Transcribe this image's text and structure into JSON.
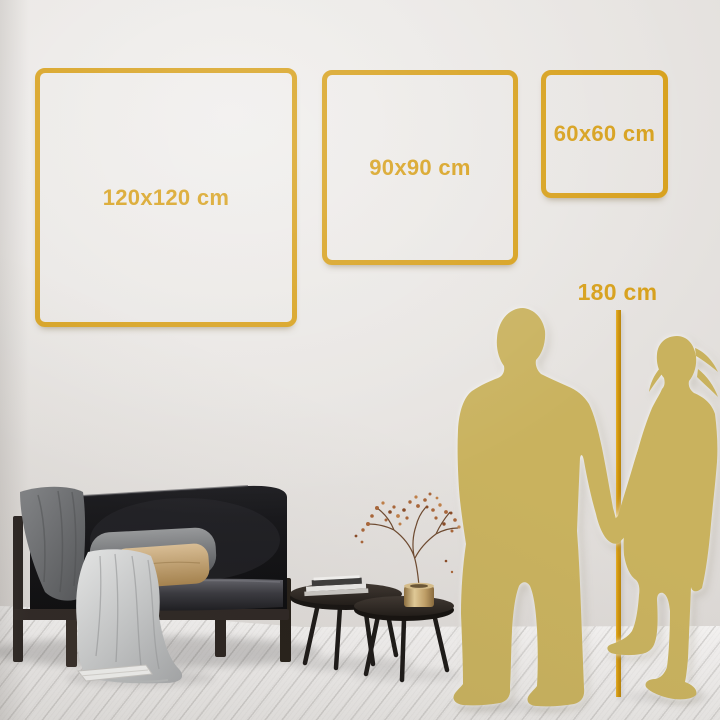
{
  "size_guide": {
    "unit": "cm",
    "frames": [
      {
        "id": "frame-120",
        "label": "120x120 cm",
        "width_cm": 120,
        "height_cm": 120
      },
      {
        "id": "frame-90",
        "label": "90x90 cm",
        "width_cm": 90,
        "height_cm": 90
      },
      {
        "id": "frame-60",
        "label": "60x60 cm",
        "width_cm": 60,
        "height_cm": 60
      }
    ],
    "reference_height": {
      "label": "180 cm",
      "value_cm": 180
    }
  },
  "colors": {
    "accent_gold": "#D7A01B",
    "ruler_gold": "#D3970D",
    "silhouette_gold": "#C9B25E",
    "wall": "#E6E3E0",
    "floor": "#F2F1EF"
  },
  "scene_icons": [
    "man-silhouette",
    "woman-silhouette",
    "height-ruler-line",
    "sofa",
    "dark-throw-blanket",
    "light-throw-blanket",
    "gray-pillow",
    "tan-pillow",
    "nesting-coffee-tables",
    "books-stack",
    "brass-vase-dried-branch",
    "magazine-on-floor"
  ]
}
